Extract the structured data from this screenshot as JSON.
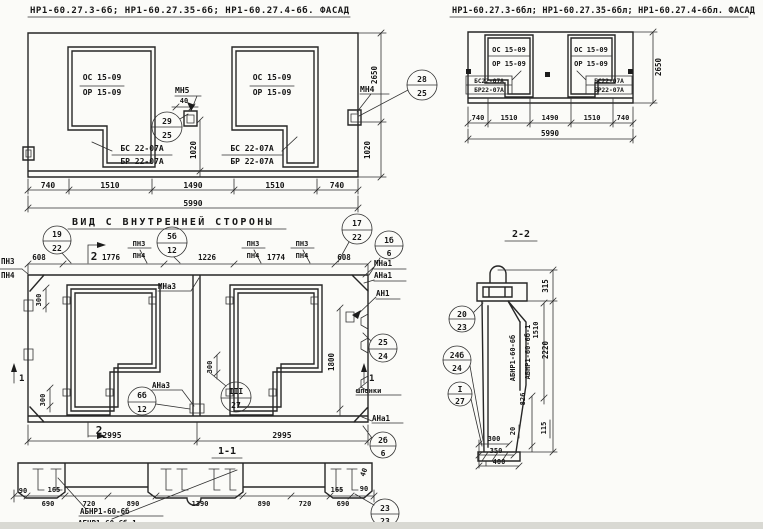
{
  "palette": {
    "paper": "#fbfbf8",
    "ink": "#262626"
  },
  "facade_left": {
    "title": "НР1-60.27.3-6б; НР1-60.27.35-6б; НР1-60.27.4-6б. ФАСАД",
    "win1_top": "ОС 15-09",
    "win1_bot": "ОР 15-09",
    "win2_top": "ОС 15-09",
    "win2_bot": "ОР 15-09",
    "sill1_top": "БС 22-07А",
    "sill1_bot": "БР 22-07А",
    "sill2_top": "БС 22-07А",
    "sill2_bot": "БР 22-07А",
    "mn5": "МН5",
    "mn4": "МН4",
    "c29": {
      "top": "29",
      "bot": "25"
    },
    "c28": {
      "top": "28",
      "bot": "25"
    },
    "dim40": "40",
    "dim1020": "1020",
    "dim2650": "2650",
    "dims": [
      "740",
      "1510",
      "1490",
      "1510",
      "740"
    ],
    "total": "5990"
  },
  "facade_right": {
    "title": "НР1-60.27.3-6бл; НР1-60.27.35-6бл; НР1-60.27.4-6бл. ФАСАД",
    "win1_top": "ОС 15-09",
    "win1_bot": "ОР 15-09",
    "win2_top": "ОС 15-09",
    "win2_bot": "ОР 15-09",
    "sill1_top": "БС22-07А",
    "sill1_bot": "БР22-07А",
    "sill2_top": "БС22-07А",
    "sill2_bot": "БР22-07А",
    "dim2650": "2650",
    "dims": [
      "740",
      "1510",
      "1490",
      "1510",
      "740"
    ],
    "total": "5990"
  },
  "inner_view": {
    "title": "ВИД С ВНУТРЕННЕЙ СТОРОНЫ",
    "pn3": "ПН3",
    "pn4": "ПН4",
    "dim608": "608",
    "dim1776": "1776",
    "dim1226": "1226",
    "dim1774": "1774",
    "c19": {
      "top": "19",
      "bot": "22"
    },
    "c5b": {
      "top": "5б",
      "bot": "12"
    },
    "c17": {
      "top": "17",
      "bot": "22"
    },
    "c1b": {
      "top": "1б",
      "bot": "6"
    },
    "c25": {
      "top": "25",
      "bot": "24"
    },
    "c6b": {
      "top": "6б",
      "bot": "12"
    },
    "c3": {
      "top": "III",
      "bot": "27"
    },
    "c2b": {
      "top": "2б",
      "bot": "6"
    },
    "mna1": "МНа1",
    "ana1": "АНа1",
    "an1": "АН1",
    "mna3": "МНа3",
    "ana3": "АНа3",
    "shponki": "шпонки",
    "dim300": "300",
    "dim1800": "1800",
    "dim2995": "2995",
    "sec1": "1",
    "sec2": "2"
  },
  "section11": {
    "title": "1-1",
    "dim90": "90",
    "dim165": "165",
    "dim690": "690",
    "dim720": "720",
    "dim890": "890",
    "dim1390": "1390",
    "dim40": "40",
    "label1": "АБНР1-60-6б",
    "label2": "АБНР1-60-6б-1",
    "c23": {
      "top": "23",
      "bot": "23"
    }
  },
  "section22": {
    "title": "2-2",
    "label1": "АБНР1-60-6б",
    "label2": "АБНР1-60-6б-1",
    "dim315": "315",
    "dim2220": "2220",
    "dim1510": "1510",
    "dim826": "826",
    "dim20": "20",
    "dim115": "115",
    "dim300": "300",
    "dim350": "350",
    "dim400": "400",
    "c20": {
      "top": "20",
      "bot": "23"
    },
    "c24b": {
      "top": "24б",
      "bot": "24"
    },
    "cI": {
      "top": "I",
      "bot": "27"
    }
  }
}
